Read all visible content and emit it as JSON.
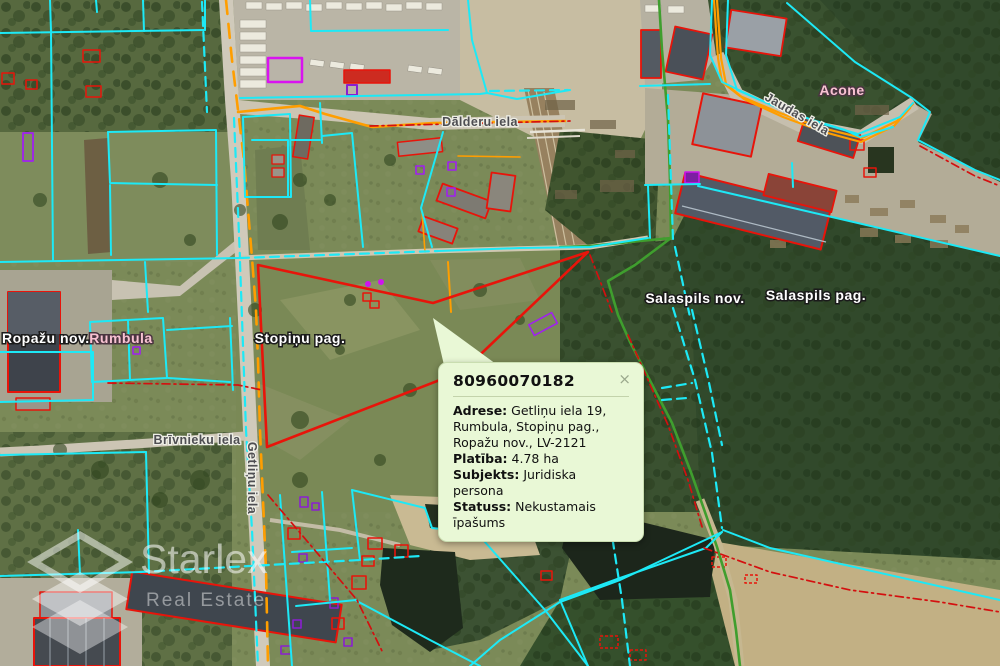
{
  "map": {
    "labels": {
      "street_dalderu": "Dālderu iela",
      "street_jaudas": "Jaudas iela",
      "street_brivnieku": "Brīvnieku iela",
      "street_getlinu": "Getliņu iela",
      "settlement_acone": "Acone",
      "settlement_rumbula": "Rumbula",
      "municipality_ropazu": "Ropažu nov.",
      "parish_stopinu": "Stopiņu pag.",
      "municipality_salaspils": "Salaspils nov.",
      "parish_salaspils": "Salaspils pag."
    },
    "colors": {
      "parcel_cyan": "#1de9f6",
      "selected_red": "#e8140a",
      "road_orange": "#ff9e00",
      "boundary_green": "#3f9e2e",
      "zoning_magenta": "#cf1fd8"
    }
  },
  "popup": {
    "title": "80960070182",
    "close_label": "×",
    "fields": [
      {
        "label": "Adrese:",
        "value": "Getliņu iela 19, Rumbula, Stopiņu pag., Ropažu nov., LV-2121"
      },
      {
        "label": "Platība:",
        "value": "4.78 ha"
      },
      {
        "label": "Subjekts:",
        "value": "Juridiska persona"
      },
      {
        "label": "Statuss:",
        "value": "Nekustamais īpašums"
      }
    ]
  },
  "watermark": {
    "brand": "Starlex",
    "tagline": "Real Estate"
  }
}
